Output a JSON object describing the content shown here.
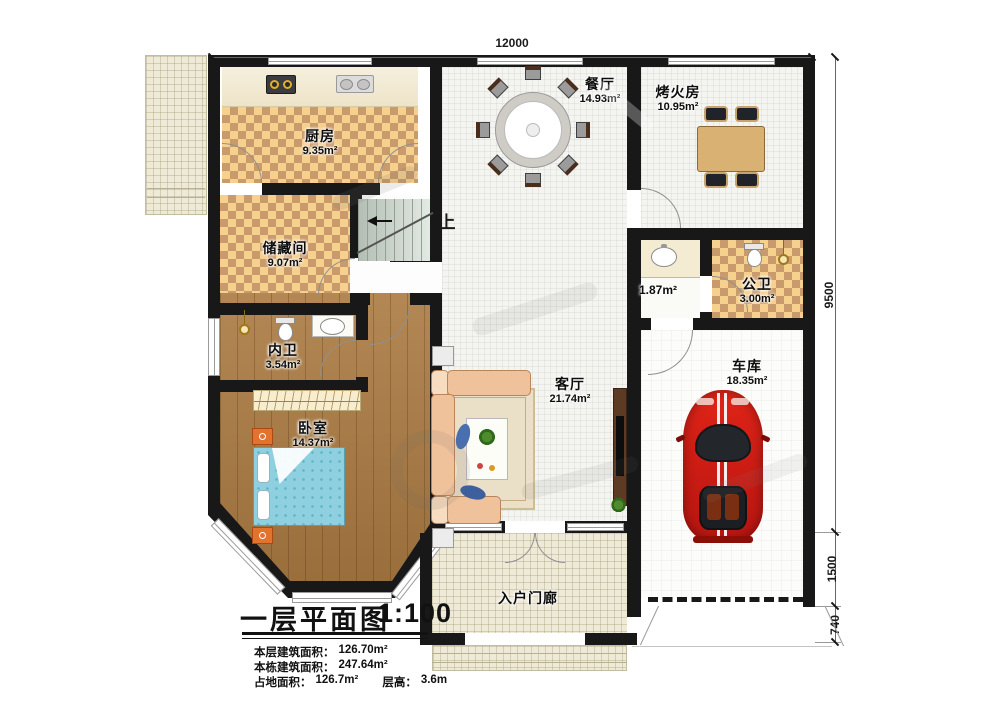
{
  "plan": {
    "dimensions": {
      "top_width": "12000",
      "right_main": "9500",
      "right_front": "1500",
      "right_step": "740"
    },
    "rooms": {
      "kitchen": {
        "name": "厨房",
        "area": "9.35m²"
      },
      "storage": {
        "name": "储藏间",
        "area": "9.07m²"
      },
      "dining": {
        "name": "餐厅",
        "area": "14.93m²"
      },
      "fire_room": {
        "name": "烤火房",
        "area": "10.95m²"
      },
      "hall_vanity": {
        "area": "1.87m²"
      },
      "public_bath": {
        "name": "公卫",
        "area": "3.00m²"
      },
      "private_bath": {
        "name": "内卫",
        "area": "3.54m²"
      },
      "bedroom": {
        "name": "卧室",
        "area": "14.37m²"
      },
      "living": {
        "name": "客厅",
        "area": "21.74m²"
      },
      "garage": {
        "name": "车库",
        "area": "18.35m²"
      },
      "porch": {
        "name": "入户门廊"
      },
      "stairs": {
        "direction": "上"
      }
    },
    "title_block": {
      "title": "一层平面图",
      "scale": "1:100",
      "rows": [
        {
          "label": "本层建筑面积：",
          "value": "126.70m²"
        },
        {
          "label": "本栋建筑面积：",
          "value": "247.64m²"
        },
        {
          "label": "占地面积：",
          "value": "126.7m²",
          "label2": "层高：",
          "value2": "3.6m"
        }
      ]
    }
  }
}
